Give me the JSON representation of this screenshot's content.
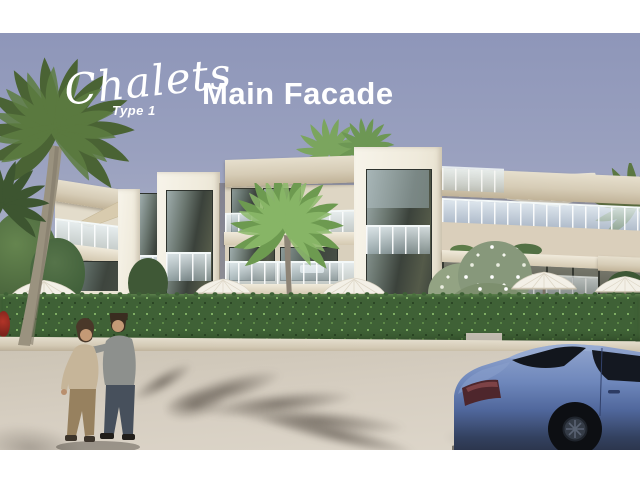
{
  "header": {
    "brand_script": "Chalets",
    "brand_sub": "Type 1",
    "title": "Main Facade",
    "text_color": "#ffffff"
  },
  "scene": {
    "type": "architectural-render",
    "subject": "Main facade of a modern three-storey chalet apartment building with palm trees, hedge, two pedestrians and a parked blue sedan",
    "colors": {
      "sky_top": "#8e96b9",
      "sky_bottom": "#cfcdd3",
      "building_cream": "#d6ccb8",
      "building_white": "#f2eee2",
      "window_dark": "#41473f",
      "balustrade_glass": "#d6e2e8",
      "hedge_green": "#3f6136",
      "road": "#d6cec1",
      "cast_shadow": "#57504a",
      "car_blue": "#5f7bb4",
      "umbrella_white": "#f3f0e7",
      "palm_dark": "#4a6334",
      "palm_light": "#76a258"
    }
  }
}
